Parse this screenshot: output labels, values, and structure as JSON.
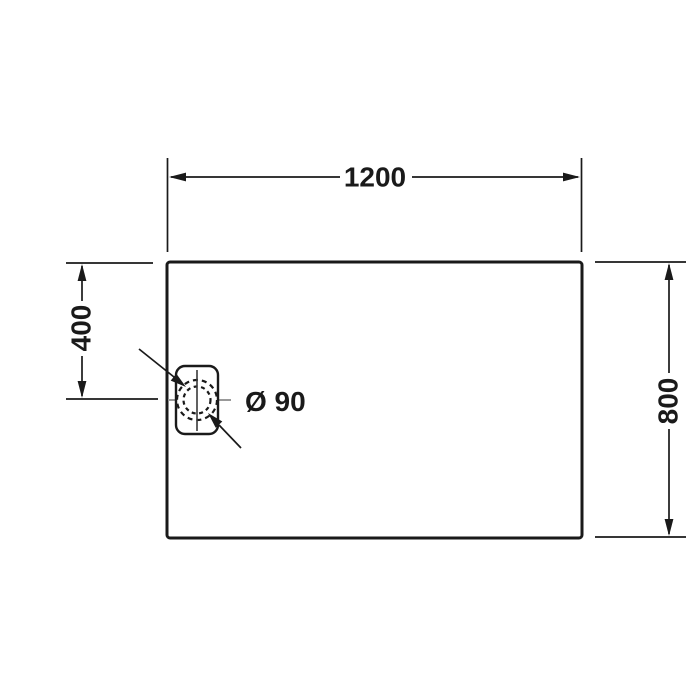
{
  "drawing": {
    "type": "technical-dimension-drawing",
    "subject": "rectangular shower tray, top view with drain",
    "labels": {
      "width": "1200",
      "height": "800",
      "drain_offset": "400",
      "drain_diameter": "Ø 90"
    },
    "colors": {
      "line": "#1a1a1a",
      "centerline": "#999999",
      "background": "#ffffff"
    }
  }
}
